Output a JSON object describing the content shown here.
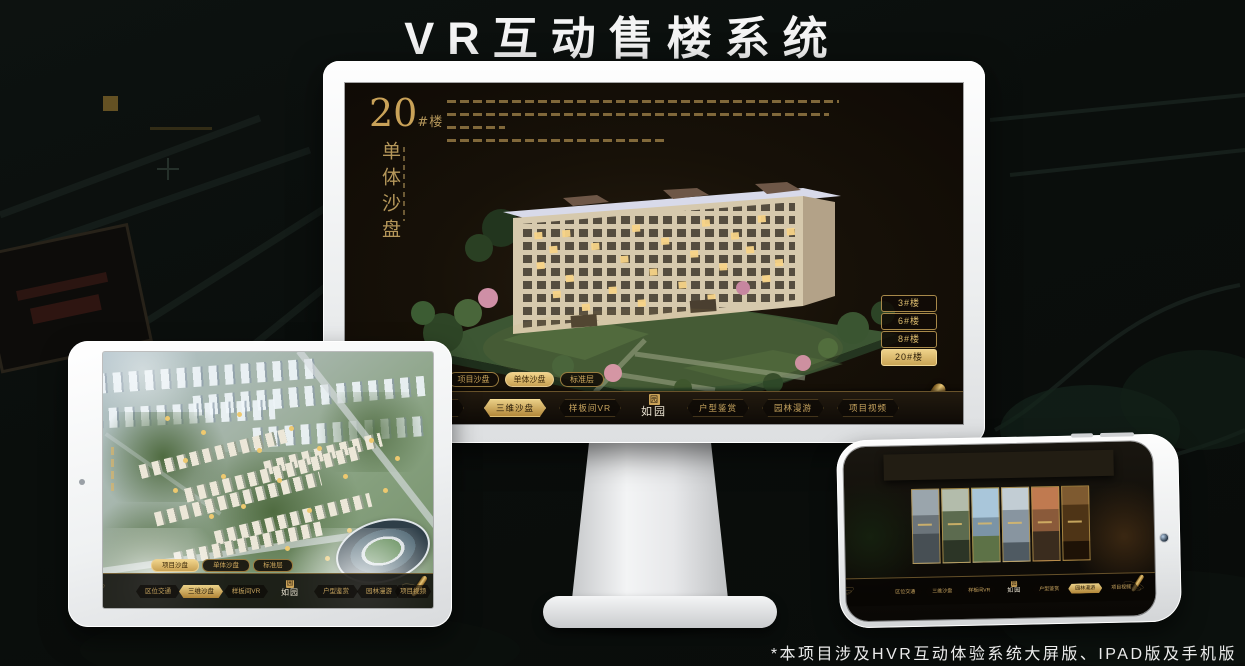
{
  "title": "VR互动售楼系统",
  "footnote": "*本项目涉及HVR互动体验系统大屏版、IPAD版及手机版",
  "colors": {
    "gold": "#c9a45c",
    "gold_bright": "#ecd28a",
    "active_pill_bg": "#ddb96d",
    "screen_bg": "#171108",
    "device_white": "#f5f6f7",
    "lit_window": "#f8d488"
  },
  "app": {
    "logo": "如园",
    "logo_seal": "园",
    "nav_items": [
      "区位交通",
      "三维沙盘",
      "样板间VR",
      "户型鉴赏",
      "园林漫游",
      "项目视频"
    ],
    "subtabs": [
      "项目沙盘",
      "单体沙盘",
      "标准层"
    ]
  },
  "monitor": {
    "block_number": "20",
    "block_unit": "#楼",
    "block_subtitle": "单体沙盘",
    "floor_buttons": [
      "3#楼",
      "6#楼",
      "8#楼",
      "20#楼"
    ],
    "active_floor": "20#楼",
    "active_subtab": "单体沙盘",
    "active_nav": "三维沙盘"
  },
  "ipad": {
    "active_subtab": "项目沙盘",
    "active_nav": "三维沙盘"
  },
  "phone": {
    "active_nav": "园林漫游",
    "gallery_panel_count": 6
  }
}
